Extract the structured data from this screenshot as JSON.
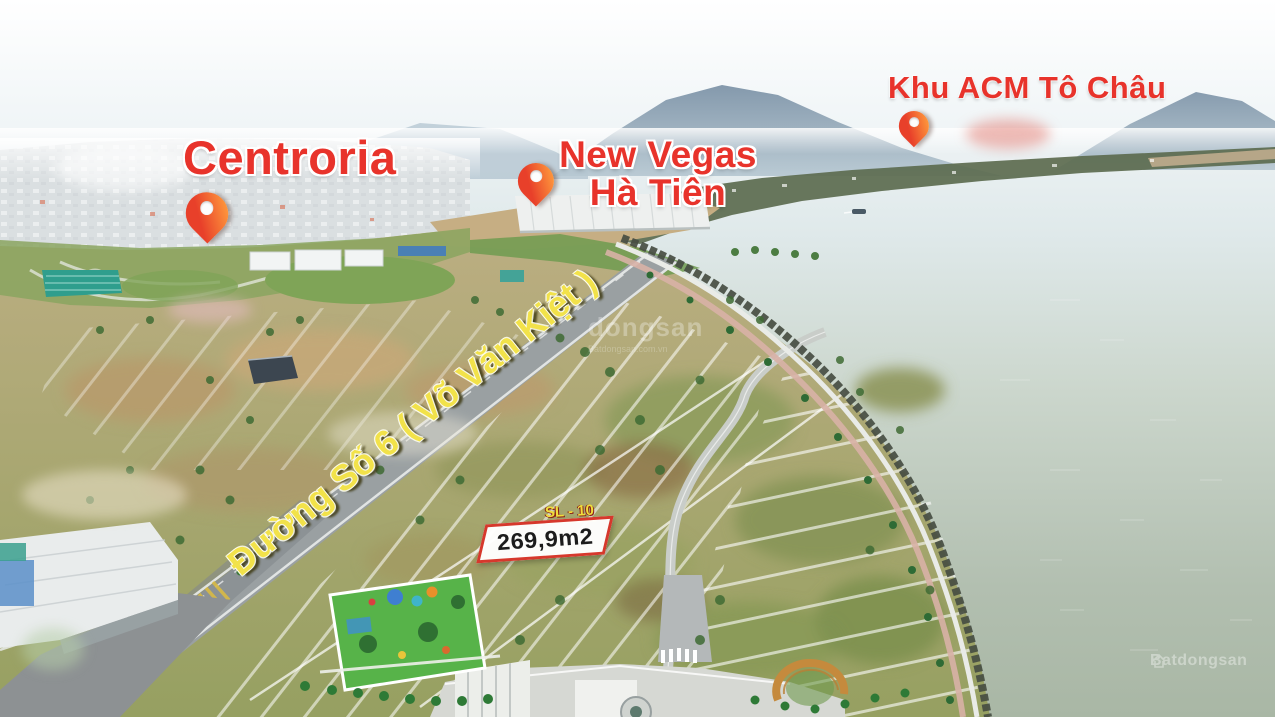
{
  "annotations": {
    "centroria": {
      "label": "Centroria"
    },
    "new_vegas": {
      "line1": "New Vegas",
      "line2": "Hà Tiên"
    },
    "khu_acm": {
      "label": "Khu ACM Tô Châu"
    },
    "road": {
      "label": "Đường Số 6 ( Võ Văn Kiệt )"
    },
    "plot": {
      "code": "SL - 10",
      "area": "269,9m2"
    }
  },
  "pins": [
    {
      "name": "centroria-pin"
    },
    {
      "name": "new-vegas-pin"
    },
    {
      "name": "acm-pin"
    }
  ],
  "watermarks": {
    "center": {
      "line1": "dongsan",
      "line2": "Batdongsan.com.vn"
    },
    "bottom_right": {
      "label": "Batdongsan"
    }
  },
  "colors": {
    "annotation_red": "#e8332b",
    "road_label_yellow": "#f2e24a",
    "plot_border_red": "#d6382c",
    "plot_code_yellow": "#f0dd3c",
    "pin_gradient_start": "#e8402a",
    "pin_gradient_end": "#ff9b3d"
  }
}
